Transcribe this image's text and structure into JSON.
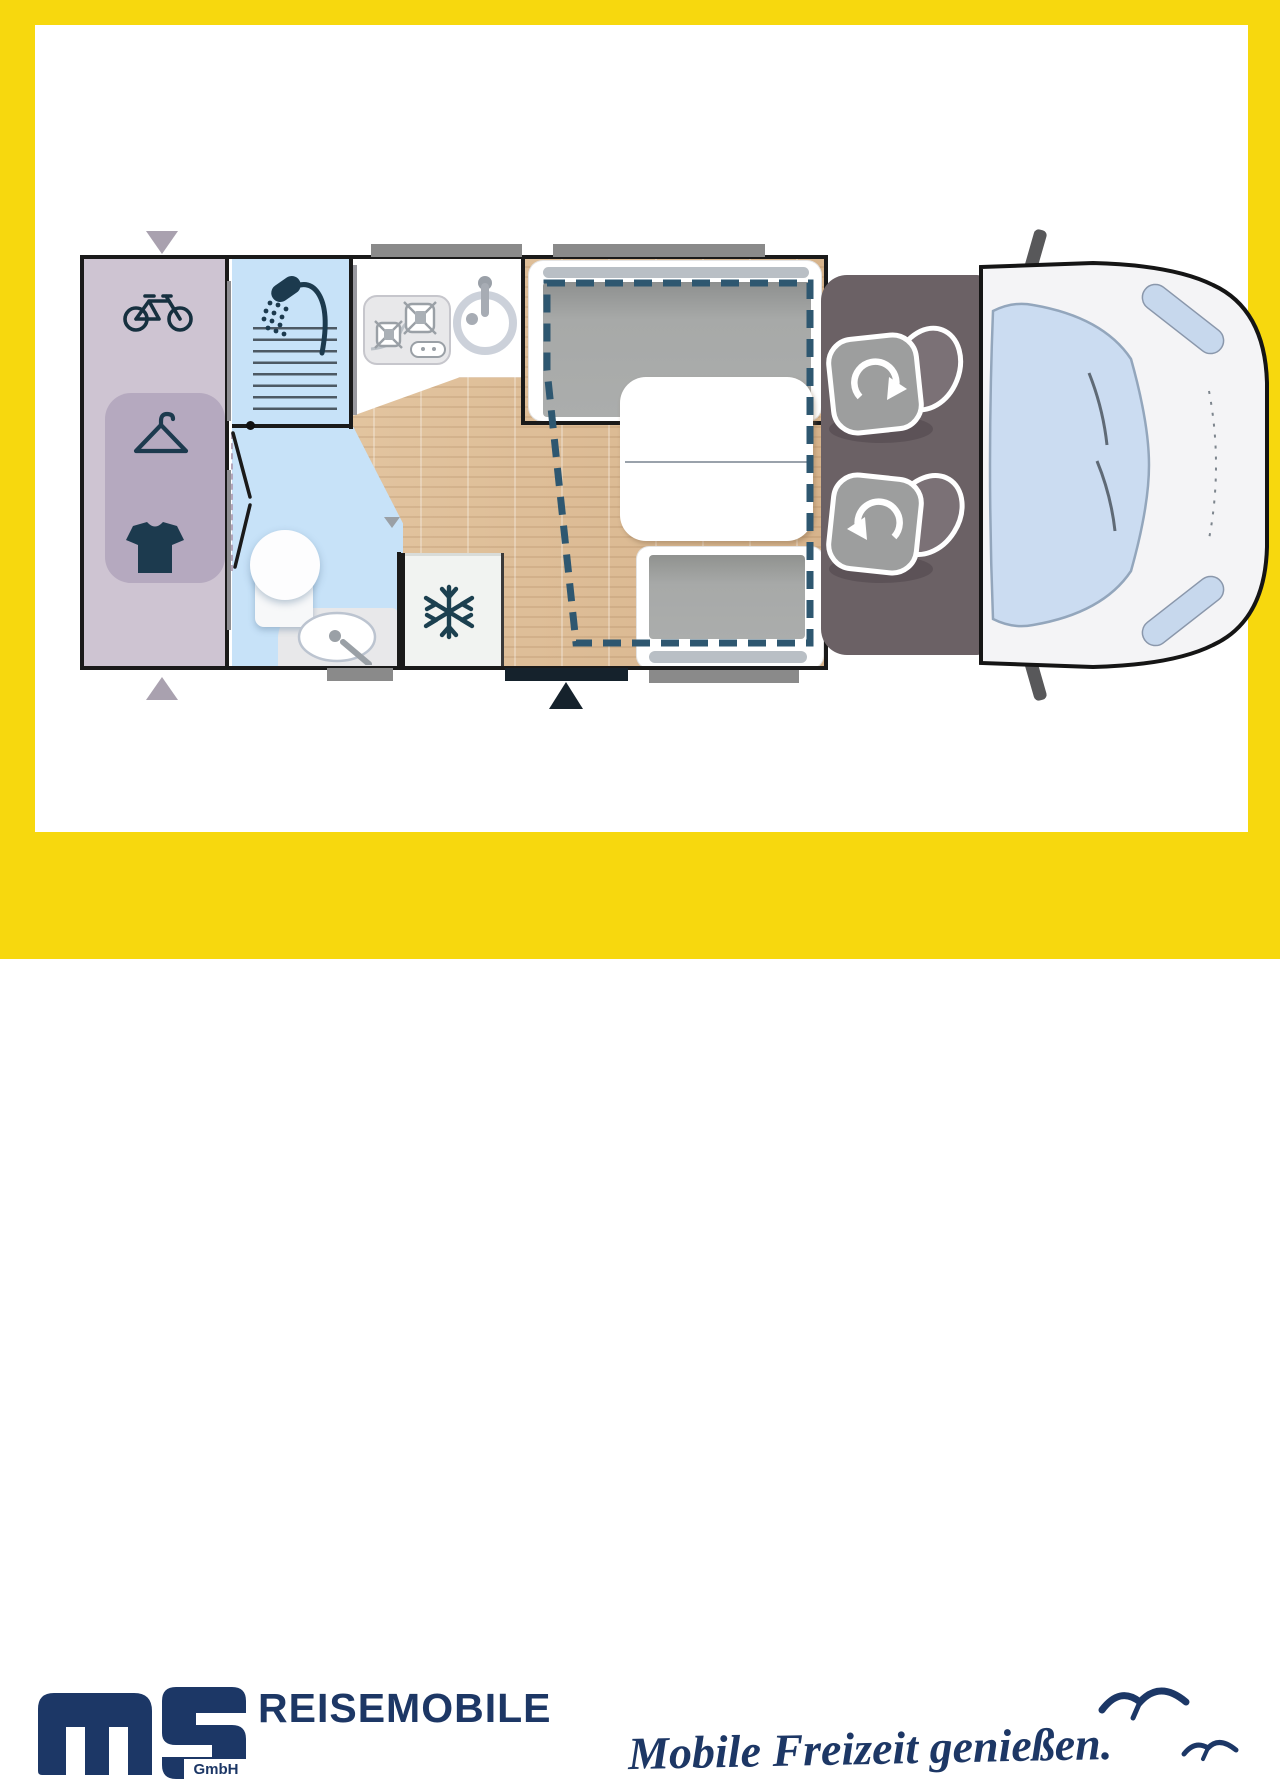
{
  "page": {
    "background_color": "#F7D80E",
    "canvas_color": "#FFFFFF",
    "content": "motorhome floor plan, top view, with dealer branding band"
  },
  "floorplan": {
    "icons": [
      "bicycle-icon",
      "coat-hanger-icon",
      "tshirt-icon",
      "shower-icon",
      "stove-icon",
      "kitchen-sink-icon",
      "snowflake-icon",
      "toilet-icon",
      "washbasin-icon",
      "swivel-seat-rotation-icon",
      "entry-door-arrow-icon",
      "garage-door-arrow-icon",
      "drop-down-bed-outline",
      "window-marker"
    ],
    "colors": {
      "garage": "#CEC4D2",
      "wardrobe": "#B5A9BF",
      "bathroom": "#C7E2F8",
      "wood_floor": "#DEC09E",
      "cab_floor": "#6B6165",
      "cushion_gray": "#A9ABAA",
      "icon_navy": "#1C3A4E",
      "bed_outline_dash": "#2E5770",
      "window_gray": "#8A8A8A",
      "entry_door": "#15222C",
      "van_body": "#F4F4F6",
      "windshield": "#CBDCF1"
    }
  },
  "footer": {
    "logo_text": "ms",
    "logo_suffix": "GmbH",
    "wordmark": "REISEMOBILE",
    "slogan": "Mobile Freizeit genießen.",
    "brand_navy": "#1C3766",
    "brand_yellow": "#F7D80E"
  }
}
